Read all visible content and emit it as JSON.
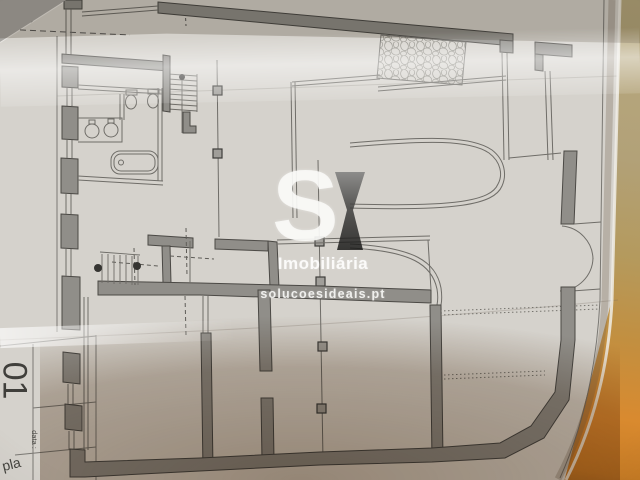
{
  "scene": {
    "description": "Photograph of an architectural floor plan sheet lying on an orange-brown surface, watermarked by a real-estate agency"
  },
  "sheet": {
    "margin_label": "corte",
    "title_block": {
      "sheet_number": "01",
      "date_label": "data :",
      "drawing_label": "pla"
    }
  },
  "watermark": {
    "logo_full": "SI",
    "logo_s": "S",
    "brand": "Imobiliária",
    "website": "solucoesideais.pt"
  },
  "colors": {
    "paper": "#d5d2cc",
    "wall_fill": "#908e89",
    "line": "#6f6d68",
    "shadow_brown": "#6e5032",
    "background_khaki": "#b2a178",
    "background_orange": "#d98a2f",
    "watermark_white": "#fafaf8",
    "logo_dark": "#2b2b2b"
  }
}
